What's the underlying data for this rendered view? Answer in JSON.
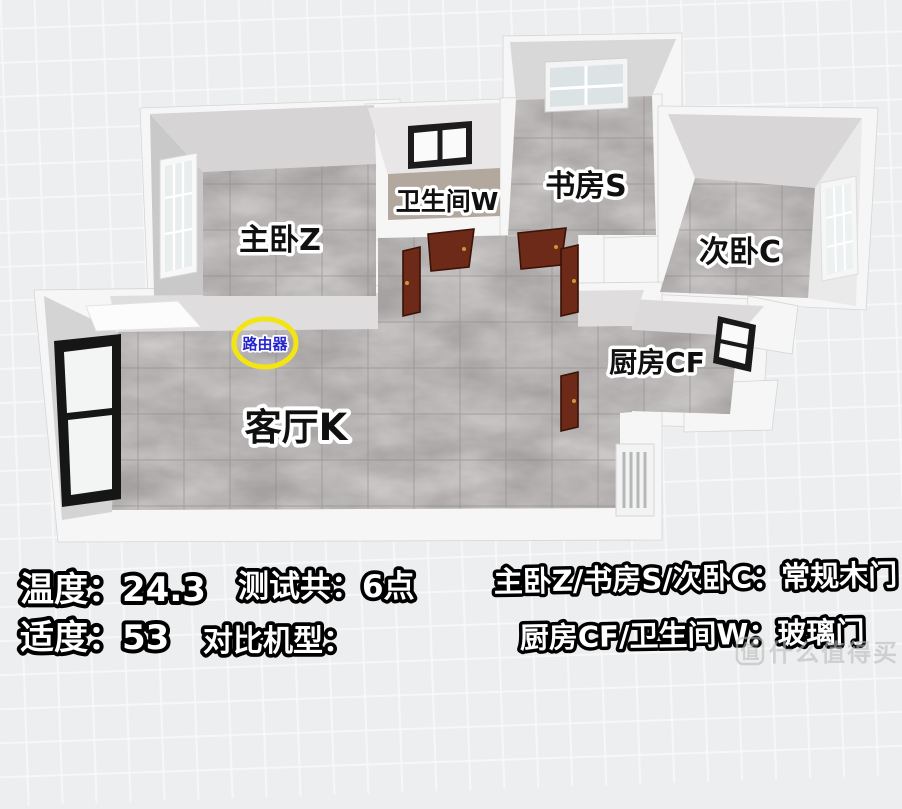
{
  "floorplan": {
    "rooms": [
      {
        "id": "master-bedroom",
        "label": "主卧Z"
      },
      {
        "id": "bathroom",
        "label": "卫生间W"
      },
      {
        "id": "study",
        "label": "书房S"
      },
      {
        "id": "second-bedroom",
        "label": "次卧C"
      },
      {
        "id": "kitchen",
        "label": "厨房CF"
      },
      {
        "id": "living-room",
        "label": "客厅K"
      }
    ],
    "router": {
      "label": "路由器",
      "text_color": "#2525d0",
      "ring_color": "#f2e512"
    },
    "colors": {
      "floor_tile": "#a5a1a1",
      "bathroom_floor": "#b2a89d",
      "wall": "#f6f6f6",
      "wood_door": "#6e2a18",
      "window_frame_dark": "#171717"
    }
  },
  "readings": {
    "temperature_label": "温度：",
    "temperature_value": "24.3",
    "humidity_label": "适度：",
    "humidity_value": "53",
    "test_points_label": "测试共：",
    "test_points_value": "6点",
    "comparison_model_label": "对比机型："
  },
  "door_legend": {
    "wood_doors": "主卧Z/书房S/次卧C：常规木门",
    "glass_doors": "厨房CF/卫生间W：玻璃门"
  },
  "watermark": {
    "logo": "值",
    "text": "什么值得买"
  }
}
